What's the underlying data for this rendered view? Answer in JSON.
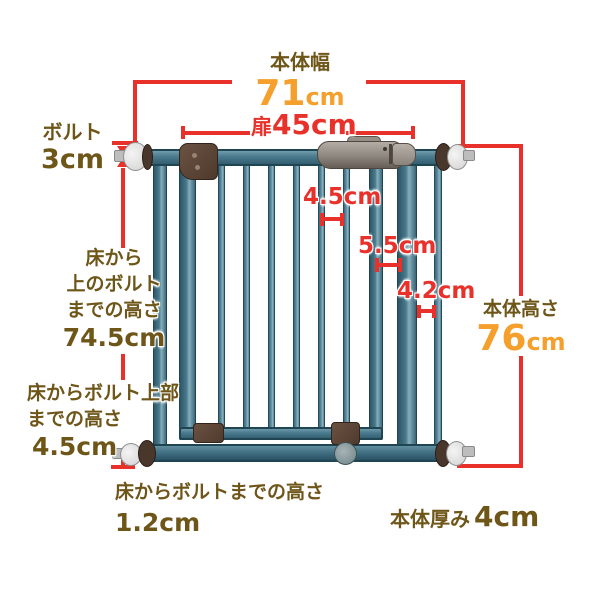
{
  "diagram_title": "baby-gate dimension diagram",
  "measurements": {
    "body_width_label": "本体幅",
    "body_width_value": "71",
    "body_width_unit": "cm",
    "door_width_prefix": "扉",
    "door_width_value": "45cm",
    "bolt_label": "ボルト",
    "bolt_value": "3cm",
    "floor_upper_bolt_line1": "床から",
    "floor_upper_bolt_line2": "上のボルト",
    "floor_upper_bolt_line3": "までの高さ",
    "floor_upper_bolt_value": "74.5cm",
    "floor_bolt_top_line1": "床からボルト上部",
    "floor_bolt_top_line2": "までの高さ",
    "floor_bolt_top_value": "4.5cm",
    "floor_bolt_line1": "床からボルトまでの高さ",
    "floor_bolt_value": "1.2cm",
    "body_height_label": "本体高さ",
    "body_height_value": "76",
    "body_height_unit": "cm",
    "body_thickness_label": "本体厚み",
    "body_thickness_value": "4cm",
    "gap_between_bars": "4.5cm",
    "gap_latch_to_frame": "5.5cm",
    "gap_frame_to_side": "4.2cm"
  },
  "colors": {
    "label_brown": "#6e5518",
    "highlight_orange": "#f5a02d",
    "dimension_red": "#e8312b",
    "gate_teal": "#4a7a8e",
    "gate_dark_teal": "#254b5c",
    "hardware_brown": "#5d4938",
    "handle_gray": "#948d85",
    "background": "#ffffff"
  }
}
